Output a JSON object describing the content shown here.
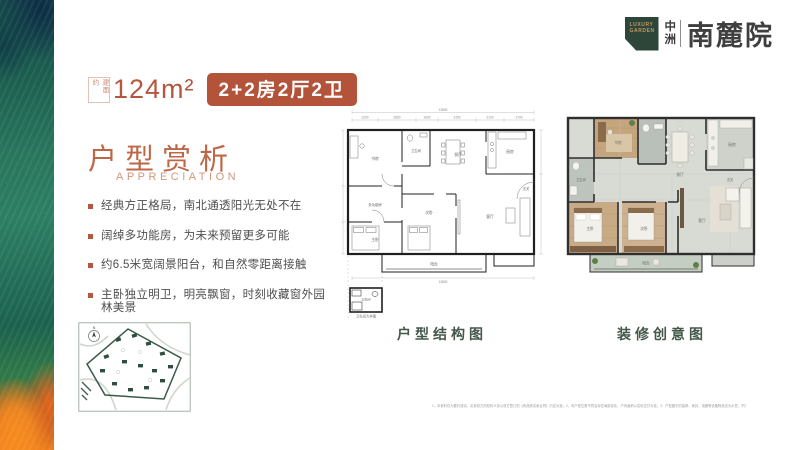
{
  "colors": {
    "accent": "#b5573e",
    "badge_bg": "#b2533a",
    "logo_green": "#2d4639",
    "logo_gold": "#c19a5f",
    "plan_label": "#44574b"
  },
  "brand": {
    "mark_line1": "LUXURY",
    "mark_line2": "GARDEN",
    "company_char1": "中",
    "company_char2": "洲",
    "project": "南麓院"
  },
  "header": {
    "area_prefix": "建面约",
    "area_value": "124m²",
    "spec_badge": "2+2房2厅2卫"
  },
  "intro": {
    "title": "户型赏析",
    "subtitle": "APPRECIATION",
    "bullets": [
      "经典方正格局，南北通透阳光无处不在",
      "阔绰多功能房，为未来预留更多可能",
      "约6.5米宽阔景阳台，和自然零距离接触",
      "主卧独立明卫，明亮飘窗，时刻收藏窗外园林美景"
    ]
  },
  "plans": {
    "rooms": {
      "study": "书房",
      "dining": "餐厅",
      "kitchen": "厨房",
      "multi": "多功能房",
      "master": "主卧",
      "bed2": "次卧",
      "living": "客厅",
      "balcony": "阳台",
      "bath": "卫生间",
      "foyer": "玄关"
    },
    "structure": {
      "label": "户型结构图",
      "dim_total": "13800",
      "dims": [
        "2200",
        "3650",
        "1600",
        "3150",
        "2100",
        "1700"
      ],
      "detail_caption": "卫生间大样图"
    },
    "decor": {
      "label": "装修创意图"
    }
  },
  "sitemap": {
    "north": "N"
  },
  "disclaimer": "1、本资料仅为要约邀请，买卖双方的权利义务以双方签订的《商品房买卖合同》约定为准；2、本户型位置不同会存在局部变化，户内面积以实际交付为准；3、户型图中的装修、家具、电器等设备物品仅为示意，不属于交付内容和交付标准，在法律允许范围内，开发商保留对本资料的修改权利，敬请留意。"
}
